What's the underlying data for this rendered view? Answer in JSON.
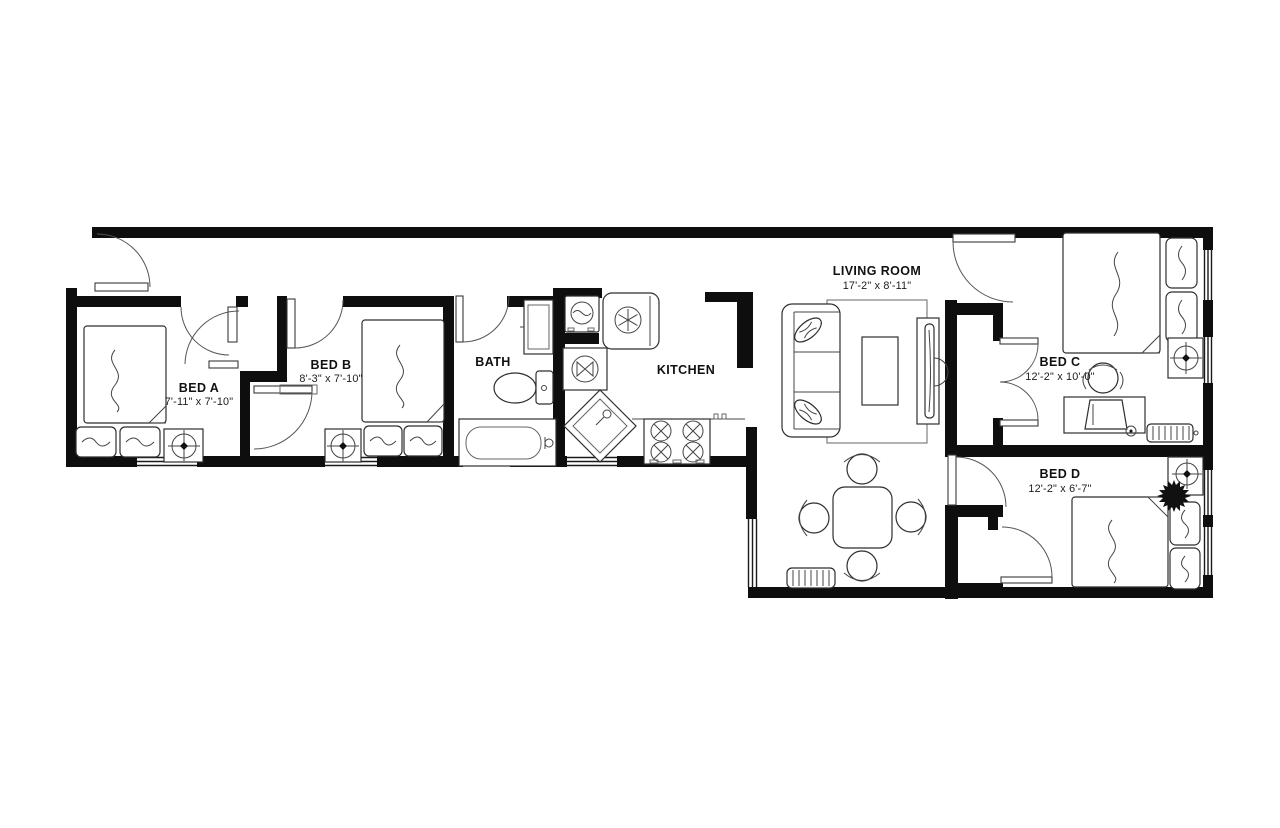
{
  "plan": {
    "background": "#ffffff",
    "wall_color": "#0e0e0e",
    "line_color": "#2e2e2e",
    "rooms": {
      "bed_a": {
        "label": "BED A",
        "dims": "7'-11\" x 7'-10\""
      },
      "bed_b": {
        "label": "BED B",
        "dims": "8'-3\" x 7'-10\""
      },
      "bath": {
        "label": "BATH"
      },
      "kitchen": {
        "label": "KITCHEN"
      },
      "living_room": {
        "label": "LIVING ROOM",
        "dims": "17'-2\" x 8'-11\""
      },
      "bed_c": {
        "label": "BED C",
        "dims": "12'-2\" x 10'-0\""
      },
      "bed_d": {
        "label": "BED D",
        "dims": "12'-2\" x 6'-7\""
      }
    },
    "fixtures": [
      "bed",
      "pillow",
      "nightstand-lamp",
      "closet-door",
      "entry-door",
      "bathtub",
      "toilet",
      "vanity",
      "washing-machine",
      "refrigerator",
      "exhaust-fan",
      "kitchen-sink",
      "range-stove",
      "sofa",
      "throw-pillow",
      "rug",
      "coffee-table",
      "tv-console",
      "dining-table",
      "dining-chair",
      "radiator",
      "desk",
      "desk-chair",
      "window",
      "plant"
    ]
  }
}
